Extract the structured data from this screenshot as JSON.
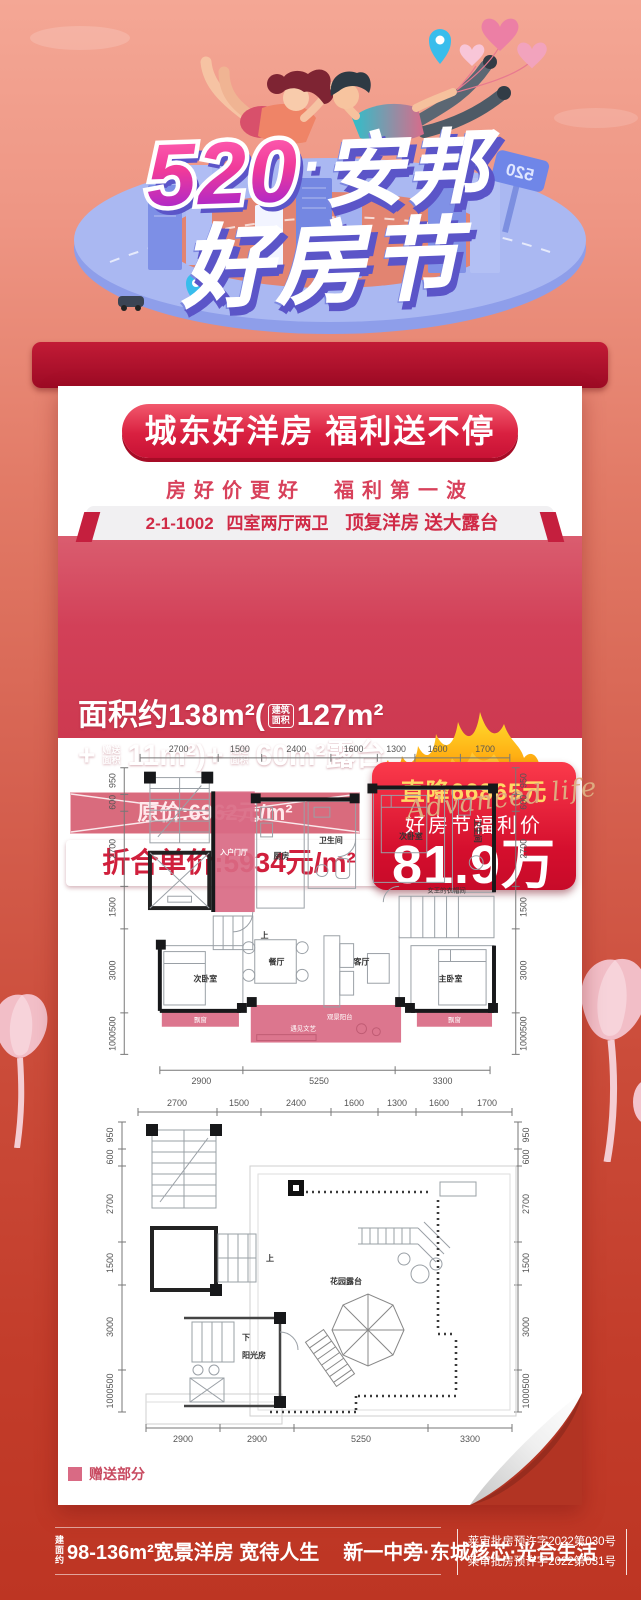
{
  "header": {
    "title": {
      "number": "520",
      "dot": "·",
      "brand": "安邦",
      "line2": "好房节"
    },
    "sign_label": "520"
  },
  "card": {
    "banner": "城东好洋房  福利送不停",
    "subtitle": "房好价更好　福利第一波",
    "unit": {
      "code": "2-1-1002",
      "layout": "四室两厅两卫",
      "highlight": "顶复洋房 送大露台"
    },
    "area": {
      "prefix": "面积约",
      "total": "138m²",
      "open": "(",
      "close": ")",
      "plus": "+",
      "v1": "127m²",
      "v2": "11m²",
      "v3": "60m²",
      "suffix": "露台",
      "badge_build": {
        "l1": "建筑",
        "l2": "面积"
      },
      "badge_gift": {
        "l1": "赠送",
        "l2": "面积"
      }
    },
    "price": {
      "original": "原价:6962元/m²",
      "unit_label": "折合单价:",
      "unit_value": "5934元/m²"
    },
    "deal": {
      "drop": "直降66865元",
      "label": "好房节福利价",
      "price": "81.9万"
    },
    "watermark": "Advanced life",
    "legend": "赠送部分"
  },
  "fp1": {
    "dims_top": [
      "2700",
      "1500",
      "2400",
      "1600",
      "1300",
      "1600",
      "1700"
    ],
    "dims_bottom": [
      "2900",
      "5250",
      "3300"
    ],
    "dims_left": [
      "950",
      "600",
      "2700",
      "1500",
      "3000",
      "1000500"
    ],
    "dims_right": [
      "950",
      "600",
      "2700",
      "1500",
      "3000",
      "1000500"
    ],
    "rooms": {
      "entry": "入户门厅",
      "up": "上",
      "kitchen": "厨房",
      "bath1": "卫生间",
      "bed_top": "次卧室",
      "bath2": "卫生间",
      "cloak": "女王的衣帽间",
      "bed2": "次卧室",
      "dining": "餐厅",
      "living": "客厅",
      "master": "主卧室",
      "bay1": "飘窗",
      "bay2": "飘窗",
      "balcony_name": "观景阳台",
      "balcony_sub": "遇见文艺"
    }
  },
  "fp2": {
    "dims_top": [
      "2700",
      "1500",
      "2400",
      "1600",
      "1300",
      "1600",
      "1700"
    ],
    "dims_bottom": [
      "2900",
      "2900",
      "5250",
      "3300"
    ],
    "dims_left": [
      "950",
      "600",
      "2700",
      "1500",
      "3000",
      "1000500"
    ],
    "dims_right": [
      "950",
      "600",
      "2700",
      "1500",
      "3000",
      "1000500"
    ],
    "rooms": {
      "up": "上",
      "down": "下",
      "sunroom": "阳光房",
      "terrace": "花园露台"
    }
  },
  "footer": {
    "area_tag": {
      "l1": "建面",
      "l2": "约"
    },
    "slogan1": "98-136m²宽景洋房 宽待人生",
    "slogan2": "新一中旁·东城核芯·光合生活",
    "permit1": "莱审批房预许字2022第030号",
    "permit2": "莱审批房预许字2022第031号"
  },
  "colors": {
    "accent_red": "#d01f3c",
    "deal_gold": "#ffd967",
    "gift_pink": "#d96a84"
  }
}
